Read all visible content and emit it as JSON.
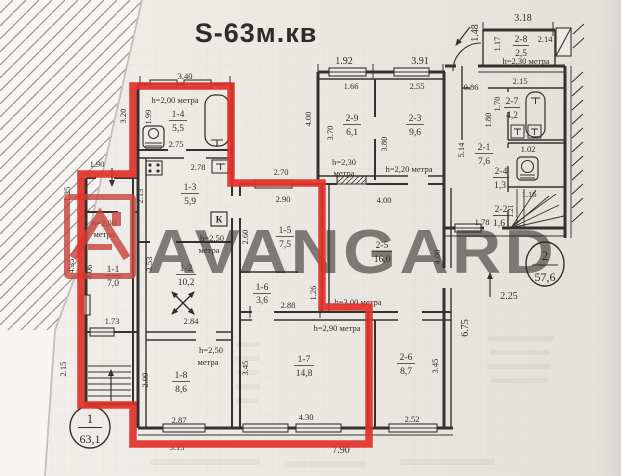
{
  "title": "S-63м.кв",
  "watermark": "AVANGARD",
  "colors": {
    "annotation_red": "#e2312b",
    "title_red": "#e8222d",
    "watermark_gray": "#959eab",
    "logo_red": "#c8423c",
    "plan_line": "#343230",
    "paper": "#eae7e2"
  },
  "stamps": {
    "apt1_number": "1",
    "apt1_area": "63,1",
    "apt2_number": "2",
    "apt2_area": "57,6"
  },
  "rooms": {
    "r11": {
      "id": "1-1",
      "area": "7,0",
      "h": [
        "h=2,00",
        "метра"
      ]
    },
    "r12": {
      "id": "1-2",
      "area": "10,2"
    },
    "r13": {
      "id": "1-3",
      "area": "5,9",
      "h": [
        "h=2,50",
        "метра"
      ]
    },
    "r14": {
      "id": "1-4",
      "area": "5,5",
      "h": [
        "h=2,00 метра"
      ]
    },
    "r15": {
      "id": "1-5",
      "area": "7,5"
    },
    "r16": {
      "id": "1-6",
      "area": "3,6"
    },
    "r17": {
      "id": "1-7",
      "area": "14,8",
      "h": [
        "h=2,90 метра"
      ]
    },
    "r18": {
      "id": "1-8",
      "area": "8,6",
      "h": [
        "h=2,50",
        "метра"
      ]
    },
    "r21": {
      "id": "2-1",
      "area": "7,6"
    },
    "r22": {
      "id": "2-2",
      "area": "1,6"
    },
    "r23": {
      "id": "2-3",
      "area": "9,6",
      "h": [
        "h=2,20 метра"
      ]
    },
    "r24": {
      "id": "2-4",
      "area": "1,3"
    },
    "r25": {
      "id": "2-5",
      "area": "16,0",
      "h": [
        "h=3,00 метра"
      ]
    },
    "r26": {
      "id": "2-6",
      "area": "8,7"
    },
    "r27": {
      "id": "2-7",
      "area": "4,2"
    },
    "r28": {
      "id": "2-8",
      "area": "2,5",
      "h": [
        "h=2,30 метра"
      ]
    },
    "r29": {
      "id": "2-9",
      "area": "6,1",
      "h": [
        "h=2,30",
        "метра"
      ]
    }
  },
  "labels": {
    "vent_channel": "К"
  },
  "dims": {
    "w14_top": "3.40",
    "v14_out": "3.20",
    "v14_in": "1.99",
    "w14_bot": "2.75",
    "w13_top": "2.78",
    "v13": "2.13",
    "v12": "3.53",
    "w12_bot": "2.84",
    "v11": "4.06",
    "v11_out": "4.35",
    "w11_bot": "1.73",
    "w_vest": "1.90",
    "v_vest_out": "1.25",
    "v_stairs1_out": "2.15",
    "v18": "2.99",
    "w18_bot": "2.87",
    "w18_out": "3.15",
    "w15_out": "2.70",
    "w15_top": "2.90",
    "v15": "2.60",
    "w16_bot": "2.88",
    "v17": "3.45",
    "w17_bot": "4.30",
    "w_bot_out": "7.90",
    "w25_top": "4.00",
    "v25_right": "4.00",
    "v25_left": "1.26",
    "v26": "3.45",
    "w26_bot": "2.52",
    "v26_out": "6.75",
    "w29_out": "1.92",
    "w29_top": "1.66",
    "v29": "3.70",
    "v29_out": "4.00",
    "w23_out": "3.91",
    "w23_top": "2.55",
    "v23": "3.80",
    "w_hall2": "0.86",
    "v21": "5.14",
    "w27_top": "2.15",
    "v27_a": "1.70",
    "v27_b": "1.80",
    "w24_top": "1.02",
    "w22_top": "1.16",
    "v22": "1.21",
    "w22_bot": "1.78",
    "w28_out": "3.18",
    "v28_out": "1.48",
    "v28_in": "1.17",
    "w28_right": "2.14",
    "w_entry2": "2.25"
  },
  "icons": [
    "bath-icon",
    "water-heater-icon",
    "stove-icon",
    "sink-icon",
    "vent-box-icon",
    "relocation-arrows-icon",
    "stairs-up-icon",
    "winder-stairs-icon",
    "toilet-icon",
    "door-arc-icon",
    "entrance-arrow-icon",
    "window-icon"
  ]
}
